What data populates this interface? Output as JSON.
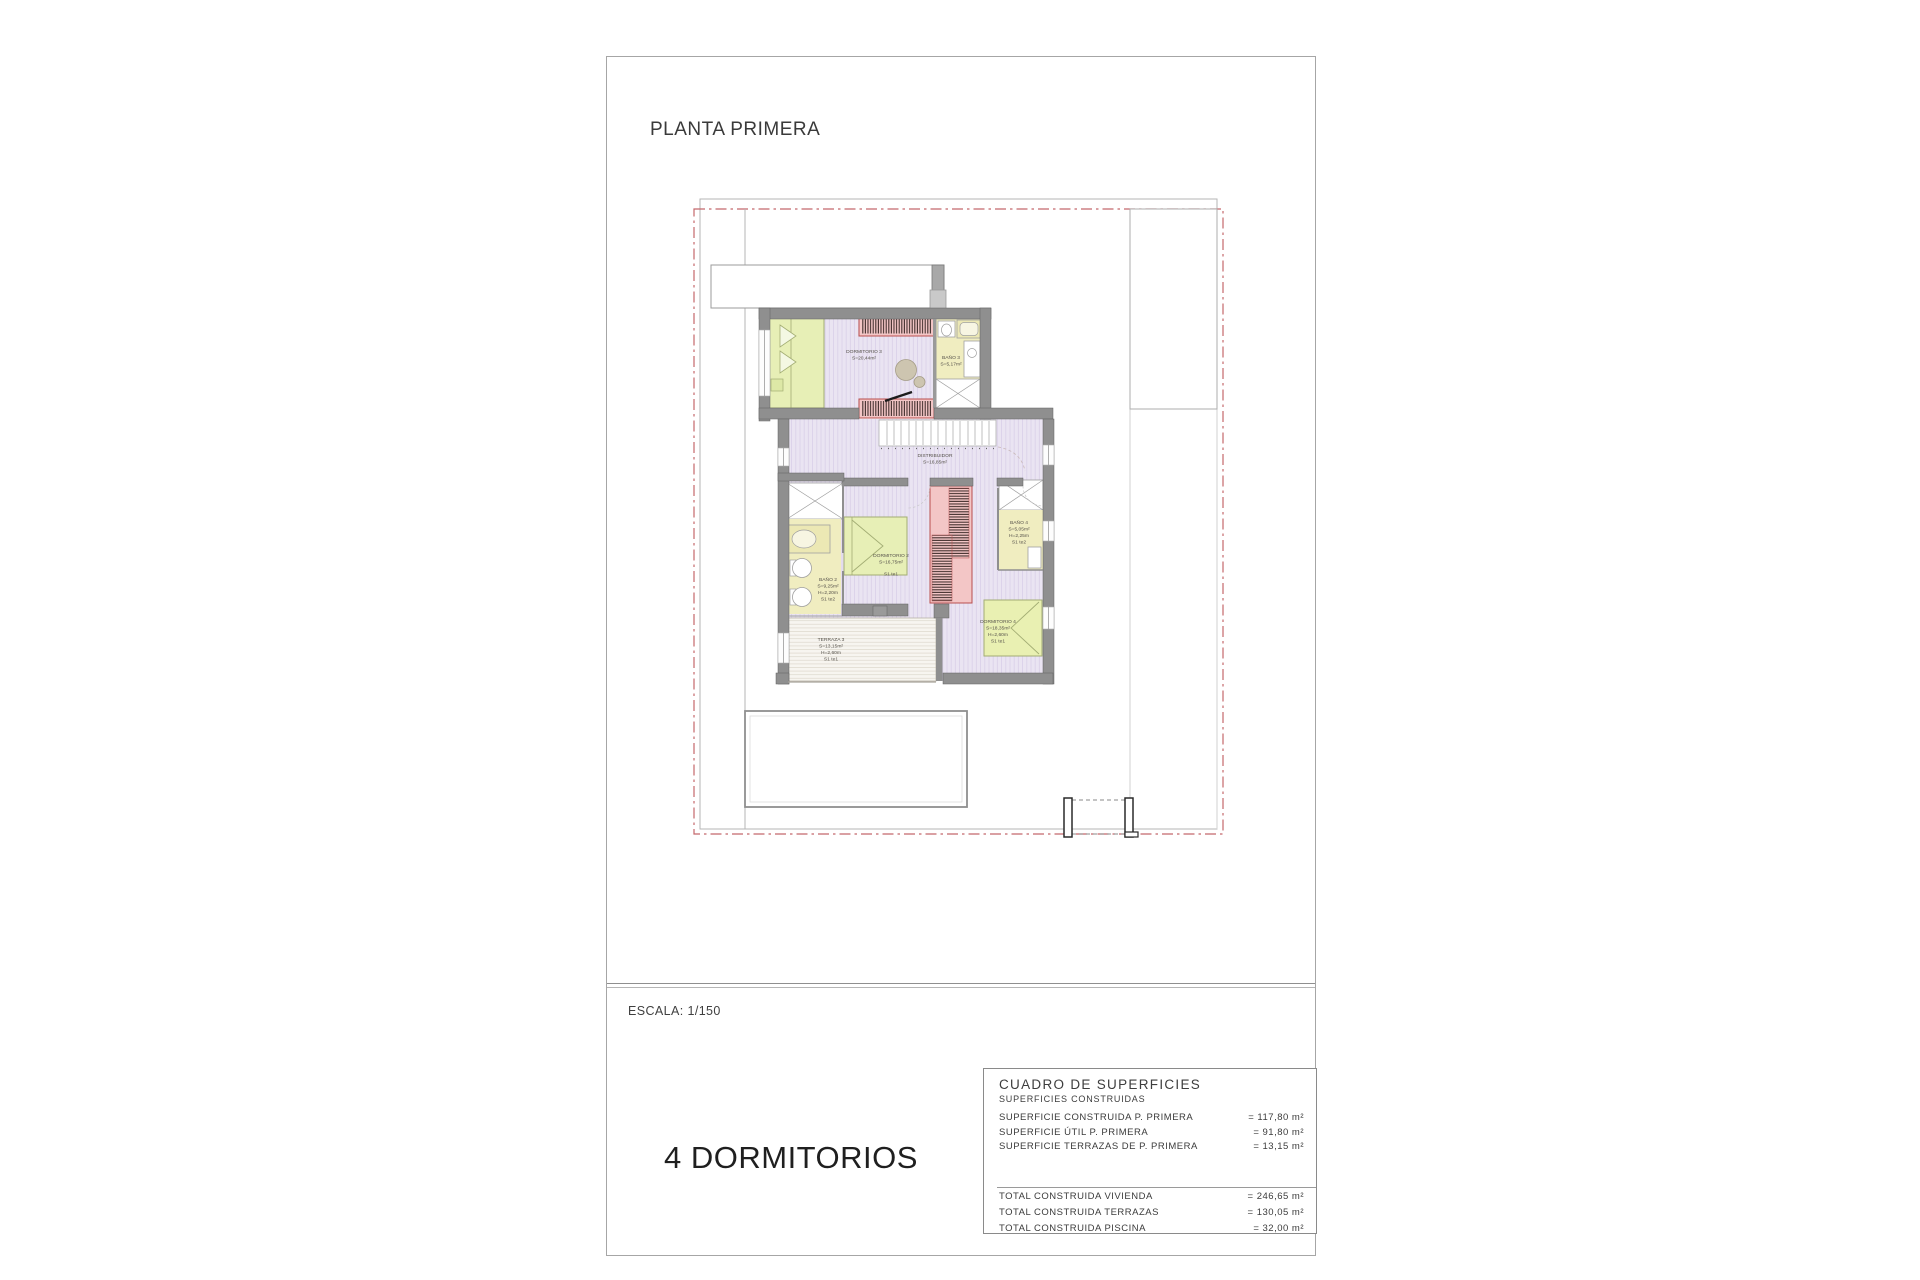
{
  "page": {
    "title": "PLANTA PRIMERA",
    "scale_label": "ESCALA: 1/150",
    "bedrooms_label": "4 DORMITORIOS"
  },
  "plan": {
    "rooms": {
      "dormitorio3": {
        "name": "DORMITORIO 3",
        "area": "S=20,44m²"
      },
      "bano3": {
        "name": "BAÑO 3",
        "area": "S=5,17m²"
      },
      "distribuidor": {
        "name": "DISTRIBUIDOR",
        "area": "S=16,85m²"
      },
      "dormitorio2": {
        "name": "DORMITORIO 2",
        "area": "S=16,75m²",
        "ref": "S1 te1"
      },
      "bano2": {
        "name": "BAÑO 2",
        "area": "S=9,25m²",
        "height": "H=2,20m",
        "ref": "S1 te2"
      },
      "bano4": {
        "name": "BAÑO 4",
        "area": "S=5,05m²",
        "height": "H=2,25m",
        "ref": "S1 te2"
      },
      "dormitorio4": {
        "name": "DORMITORIO 4",
        "area": "S=18,35m²",
        "height": "H=2,60m",
        "ref": "S1 te1"
      },
      "terraza3": {
        "name": "TERRAZA 3",
        "area": "S=13,15m²",
        "height": "H=2,60m",
        "ref": "S1 te1"
      }
    }
  },
  "surfaces_table": {
    "title": "CUADRO DE SUPERFICIES",
    "subtitle": "SUPERFICIES CONSTRUIDAS",
    "rows": [
      {
        "label": "SUPERFICIE CONSTRUIDA P. PRIMERA",
        "value": "= 117,80 m²"
      },
      {
        "label": "SUPERFICIE ÚTIL P. PRIMERA",
        "value": "= 91,80 m²"
      },
      {
        "label": "SUPERFICIE TERRAZAS DE P. PRIMERA",
        "value": "= 13,15 m²"
      }
    ],
    "totals": [
      {
        "label": "TOTAL CONSTRUIDA VIVIENDA",
        "value": "= 246,65 m²"
      },
      {
        "label": "TOTAL CONSTRUIDA TERRAZAS",
        "value": "= 130,05 m²"
      },
      {
        "label": "TOTAL CONSTRUIDA PISCINA",
        "value": "= 32,00 m²"
      }
    ]
  },
  "colors": {
    "floor_lavender": "#eae4f2",
    "bath_yellow": "#f0edc0",
    "bed_green": "#e7efb6",
    "wardrobe_pink": "#f3c6c6",
    "wardrobe_red": "#b84f4f",
    "wall_gray": "#8f8f8f",
    "boundary_red": "#c4686c"
  }
}
